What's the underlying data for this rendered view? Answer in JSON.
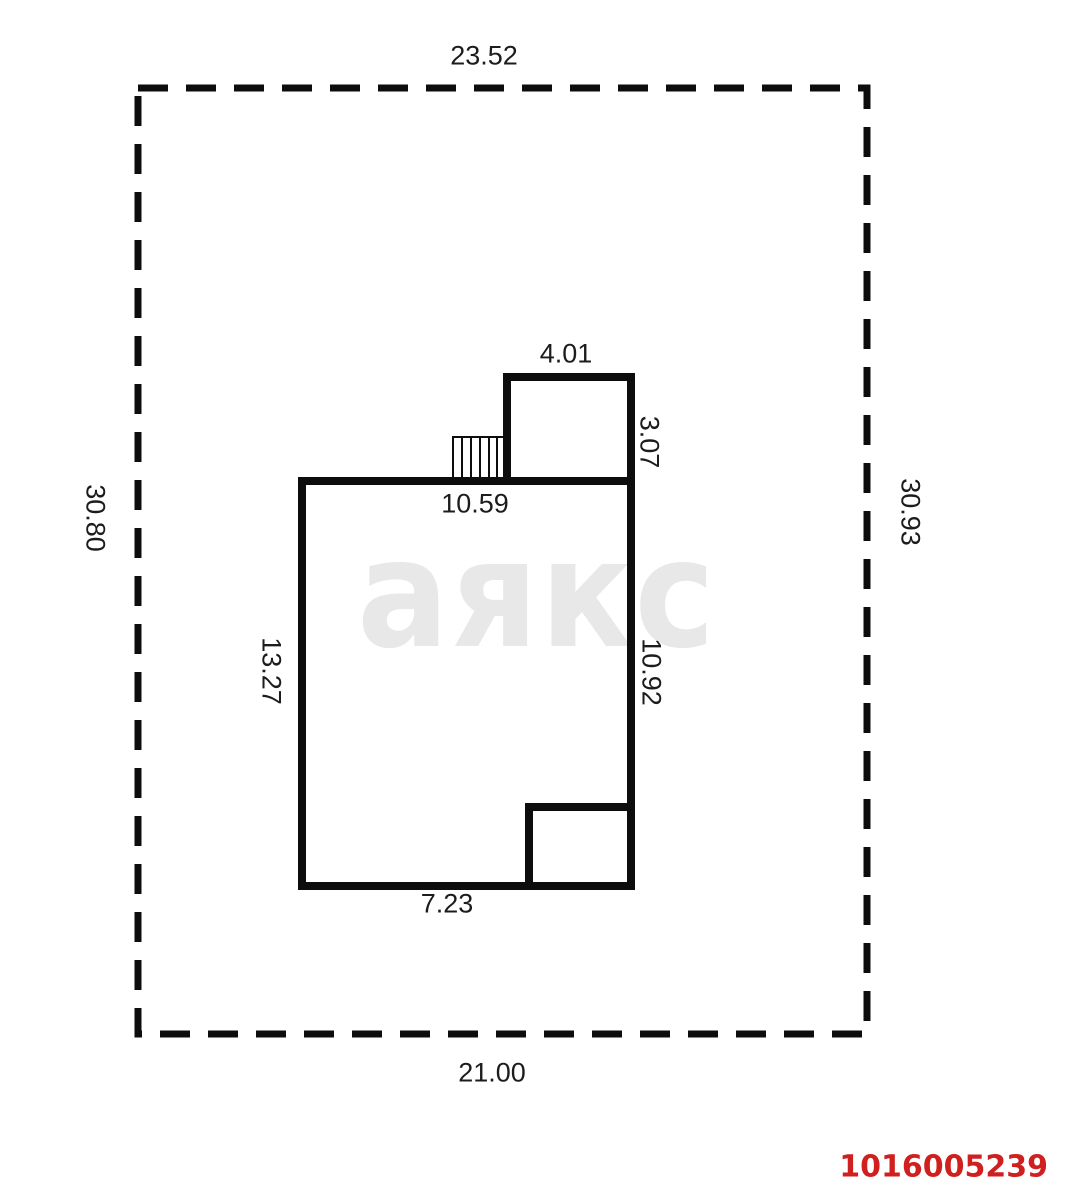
{
  "site": {
    "width_top": "23.52",
    "height_left": "30.80",
    "height_right": "30.93",
    "width_bottom": "21.00"
  },
  "building": {
    "top_width": "10.59",
    "left_height": "13.27",
    "right_height": "10.92",
    "bottom_width": "7.23",
    "annex_top_width": "4.01",
    "annex_right_height": "3.07"
  },
  "watermark": {
    "text": "аякс",
    "color": "#e8e8e8"
  },
  "plan_id": {
    "text": "1016005239",
    "color": "#d01f1f"
  },
  "colors": {
    "line": "#0d0d0d",
    "background": "#ffffff"
  }
}
